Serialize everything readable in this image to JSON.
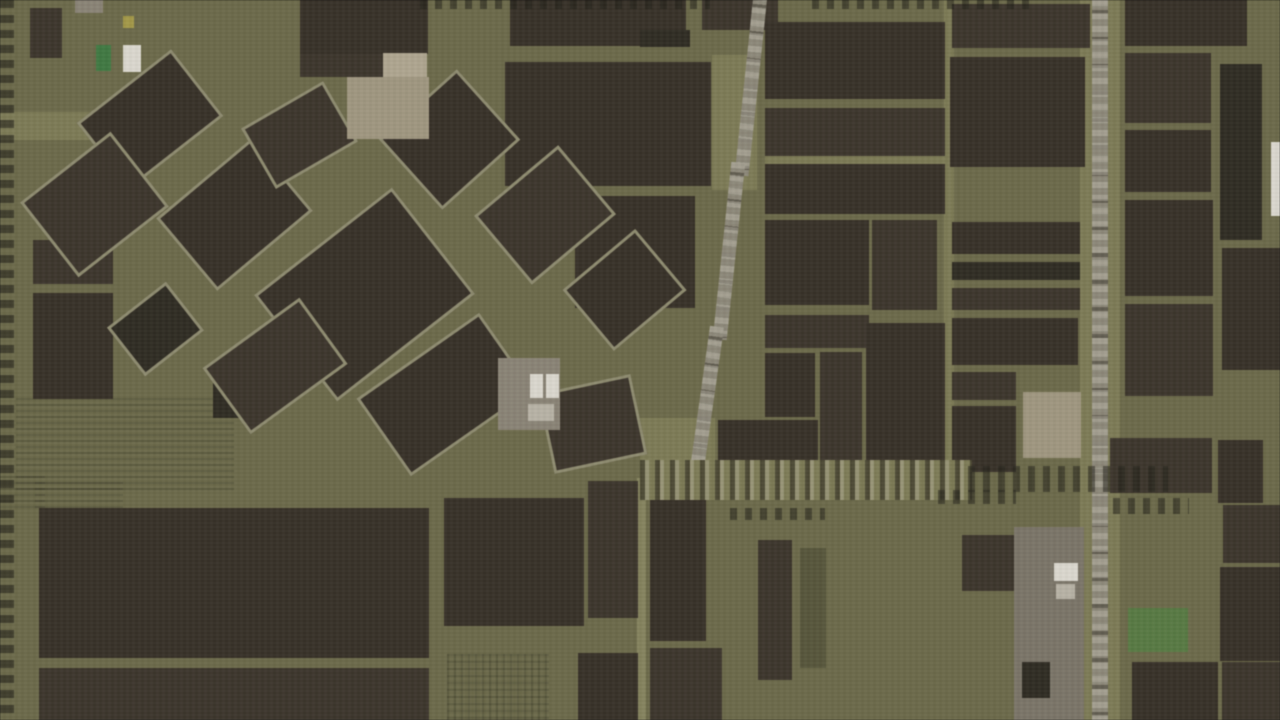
{
  "map": {
    "width": 1280,
    "height": 720,
    "palette": {
      "bg": "#6c6a47",
      "olight": "#7d7b53",
      "olight2": "#85835c",
      "odark": "#565538",
      "f1": "#362f26",
      "f2": "#3b342a",
      "f3": "#2e2a21",
      "tan": "#a1977f",
      "tanl": "#b0a78f",
      "gray": "#8b8475",
      "grayd": "#7b7567",
      "lgray": "#b9b4a6",
      "white": "#dddad0",
      "green": "#3d7a3f",
      "bgreen": "#567a40",
      "yellow": "#a59a43",
      "road": "#8d8878"
    },
    "shapes": [
      {
        "n": "light-band",
        "x": 0,
        "y": 112,
        "w": 100,
        "h": 28,
        "c": "olight"
      },
      {
        "n": "light-gap",
        "x": 944,
        "y": 0,
        "w": 10,
        "h": 476,
        "c": "olight"
      },
      {
        "n": "road-verge",
        "x": 1080,
        "y": 0,
        "w": 14,
        "h": 720,
        "c": "olight"
      },
      {
        "n": "road-verge",
        "x": 1108,
        "y": 0,
        "w": 12,
        "h": 720,
        "c": "olight"
      },
      {
        "n": "light-gap",
        "x": 765,
        "y": 152,
        "w": 182,
        "h": 12,
        "c": "olight"
      },
      {
        "n": "light-strip",
        "x": 637,
        "y": 478,
        "w": 9,
        "h": 242,
        "c": "olight2"
      },
      {
        "n": "light-patch",
        "x": 712,
        "y": 55,
        "w": 45,
        "h": 135,
        "c": "olight"
      },
      {
        "n": "light-patch",
        "x": 640,
        "y": 418,
        "w": 75,
        "h": 46,
        "c": "olight"
      },
      {
        "n": "orchard-rows",
        "x": 16,
        "y": 398,
        "w": 218,
        "h": 92,
        "t": "tx-rows"
      },
      {
        "n": "orchard-rows",
        "x": 0,
        "y": 476,
        "w": 45,
        "h": 32,
        "t": "tx-rows"
      },
      {
        "n": "orchard-rows",
        "x": 35,
        "y": 482,
        "w": 88,
        "h": 26,
        "t": "tx-rows"
      },
      {
        "n": "crop-grid",
        "x": 447,
        "y": 654,
        "w": 102,
        "h": 66,
        "t": "tx-grid"
      },
      {
        "n": "field-rows",
        "x": 730,
        "y": 508,
        "w": 95,
        "h": 12,
        "t": "tx-hdash"
      },
      {
        "n": "field-plot",
        "x": 30,
        "y": 8,
        "w": 32,
        "h": 50,
        "c": "f2"
      },
      {
        "n": "field-plot",
        "x": 300,
        "y": 0,
        "w": 128,
        "h": 54,
        "c": "f1"
      },
      {
        "n": "field-plot",
        "x": 300,
        "y": 54,
        "w": 84,
        "h": 23,
        "c": "f2"
      },
      {
        "n": "field-plot",
        "x": 510,
        "y": 0,
        "w": 176,
        "h": 46,
        "c": "f1"
      },
      {
        "n": "field-plot",
        "x": 702,
        "y": 0,
        "w": 76,
        "h": 30,
        "c": "f2"
      },
      {
        "n": "field-plot",
        "x": 505,
        "y": 62,
        "w": 206,
        "h": 124,
        "c": "f1"
      },
      {
        "n": "field-plot",
        "x": 640,
        "y": 30,
        "w": 50,
        "h": 17,
        "c": "f3"
      },
      {
        "n": "field-plot",
        "x": 765,
        "y": 22,
        "w": 180,
        "h": 77,
        "c": "f1"
      },
      {
        "n": "field-plot",
        "x": 765,
        "y": 108,
        "w": 180,
        "h": 48,
        "c": "f2"
      },
      {
        "n": "field-plot",
        "x": 765,
        "y": 164,
        "w": 180,
        "h": 50,
        "c": "f1"
      },
      {
        "n": "field-plot",
        "x": 952,
        "y": 4,
        "w": 138,
        "h": 44,
        "c": "f2"
      },
      {
        "n": "field-plot",
        "x": 950,
        "y": 57,
        "w": 135,
        "h": 110,
        "c": "f1"
      },
      {
        "n": "field-plot",
        "x": 1125,
        "y": 0,
        "w": 122,
        "h": 46,
        "c": "f1"
      },
      {
        "n": "field-plot",
        "x": 1125,
        "y": 53,
        "w": 86,
        "h": 70,
        "c": "f2"
      },
      {
        "n": "field-plot",
        "x": 1125,
        "y": 130,
        "w": 86,
        "h": 62,
        "c": "f1"
      },
      {
        "n": "field-plot",
        "x": 1220,
        "y": 64,
        "w": 42,
        "h": 176,
        "c": "f3"
      },
      {
        "n": "field-plot",
        "x": 1125,
        "y": 200,
        "w": 88,
        "h": 96,
        "c": "f1"
      },
      {
        "n": "field-plot",
        "x": 1125,
        "y": 304,
        "w": 88,
        "h": 92,
        "c": "f2"
      },
      {
        "n": "field-plot",
        "x": 1222,
        "y": 248,
        "w": 58,
        "h": 122,
        "c": "f1"
      },
      {
        "n": "field-plot",
        "x": 1110,
        "y": 438,
        "w": 102,
        "h": 55,
        "c": "f2"
      },
      {
        "n": "field-plot",
        "x": 1218,
        "y": 440,
        "w": 45,
        "h": 63,
        "c": "f1"
      },
      {
        "n": "field-plot",
        "x": 765,
        "y": 220,
        "w": 104,
        "h": 85,
        "c": "f1"
      },
      {
        "n": "field-plot",
        "x": 872,
        "y": 220,
        "w": 65,
        "h": 90,
        "c": "f2"
      },
      {
        "n": "field-plot",
        "x": 765,
        "y": 315,
        "w": 104,
        "h": 33,
        "c": "f2"
      },
      {
        "n": "field-plot",
        "x": 765,
        "y": 353,
        "w": 50,
        "h": 64,
        "c": "f1"
      },
      {
        "n": "field-plot",
        "x": 820,
        "y": 352,
        "w": 42,
        "h": 120,
        "c": "f2"
      },
      {
        "n": "field-plot",
        "x": 866,
        "y": 323,
        "w": 79,
        "h": 150,
        "c": "f1"
      },
      {
        "n": "field-plot",
        "x": 952,
        "y": 222,
        "w": 128,
        "h": 32,
        "c": "f1"
      },
      {
        "n": "field-plot",
        "x": 952,
        "y": 262,
        "w": 128,
        "h": 18,
        "c": "f3"
      },
      {
        "n": "field-plot",
        "x": 952,
        "y": 288,
        "w": 128,
        "h": 22,
        "c": "f2"
      },
      {
        "n": "field-plot",
        "x": 952,
        "y": 318,
        "w": 126,
        "h": 47,
        "c": "f1"
      },
      {
        "n": "field-plot",
        "x": 952,
        "y": 372,
        "w": 64,
        "h": 28,
        "c": "f2"
      },
      {
        "n": "field-plot",
        "x": 952,
        "y": 406,
        "w": 64,
        "h": 66,
        "c": "f1"
      },
      {
        "n": "field-plot",
        "x": 575,
        "y": 196,
        "w": 120,
        "h": 112,
        "c": "f1"
      },
      {
        "n": "field-plot",
        "x": 718,
        "y": 420,
        "w": 100,
        "h": 46,
        "c": "f1"
      },
      {
        "n": "field-plot",
        "x": 33,
        "y": 240,
        "w": 80,
        "h": 44,
        "c": "f2"
      },
      {
        "n": "field-plot",
        "x": 33,
        "y": 293,
        "w": 80,
        "h": 106,
        "c": "f1"
      },
      {
        "n": "field-plot",
        "x": 39,
        "y": 508,
        "w": 390,
        "h": 150,
        "c": "f1"
      },
      {
        "n": "field-plot",
        "x": 39,
        "y": 668,
        "w": 390,
        "h": 52,
        "c": "f2"
      },
      {
        "n": "field-plot",
        "x": 213,
        "y": 380,
        "w": 30,
        "h": 38,
        "c": "f3"
      },
      {
        "n": "field-plot",
        "x": 444,
        "y": 498,
        "w": 140,
        "h": 128,
        "c": "f1"
      },
      {
        "n": "field-plot",
        "x": 588,
        "y": 481,
        "w": 50,
        "h": 137,
        "c": "f2"
      },
      {
        "n": "field-plot",
        "x": 650,
        "y": 488,
        "w": 56,
        "h": 153,
        "c": "f1"
      },
      {
        "n": "field-plot",
        "x": 578,
        "y": 653,
        "w": 60,
        "h": 67,
        "c": "f1"
      },
      {
        "n": "field-plot",
        "x": 650,
        "y": 648,
        "w": 72,
        "h": 72,
        "c": "f2"
      },
      {
        "n": "field-plot",
        "x": 962,
        "y": 535,
        "w": 82,
        "h": 56,
        "c": "f2"
      },
      {
        "n": "field-plot",
        "x": 1132,
        "y": 662,
        "w": 86,
        "h": 58,
        "c": "f1"
      },
      {
        "n": "field-plot",
        "x": 1220,
        "y": 567,
        "w": 60,
        "h": 94,
        "c": "f1"
      },
      {
        "n": "field-plot",
        "x": 1223,
        "y": 505,
        "w": 57,
        "h": 58,
        "c": "f2"
      },
      {
        "n": "field-plot",
        "x": 1222,
        "y": 662,
        "w": 58,
        "h": 58,
        "c": "f2"
      },
      {
        "n": "field-strip",
        "x": 758,
        "y": 540,
        "w": 34,
        "h": 140,
        "c": "f2"
      },
      {
        "n": "field-strip",
        "x": 800,
        "y": 548,
        "w": 26,
        "h": 120,
        "c": "odark"
      },
      {
        "n": "field-plot-rotated",
        "x": 90,
        "y": 77,
        "w": 120,
        "h": 85,
        "c": "f1",
        "r": -38
      },
      {
        "n": "field-plot-rotated",
        "x": 37,
        "y": 157,
        "w": 115,
        "h": 95,
        "c": "f2",
        "r": -38
      },
      {
        "n": "field-plot-rotated",
        "x": 172,
        "y": 167,
        "w": 125,
        "h": 95,
        "c": "f1",
        "r": -40
      },
      {
        "n": "field-plot-rotated",
        "x": 277,
        "y": 227,
        "w": 175,
        "h": 135,
        "c": "f1",
        "r": -38
      },
      {
        "n": "field-plot-rotated",
        "x": 252,
        "y": 100,
        "w": 95,
        "h": 70,
        "c": "f2",
        "r": -30
      },
      {
        "n": "field-plot-rotated",
        "x": 397,
        "y": 92,
        "w": 105,
        "h": 95,
        "c": "f1",
        "r": -42
      },
      {
        "n": "field-plot-rotated",
        "x": 490,
        "y": 170,
        "w": 110,
        "h": 90,
        "c": "f2",
        "r": -40
      },
      {
        "n": "field-plot-rotated",
        "x": 577,
        "y": 250,
        "w": 95,
        "h": 80,
        "c": "f1",
        "r": -40
      },
      {
        "n": "field-plot-rotated",
        "x": 370,
        "y": 347,
        "w": 150,
        "h": 95,
        "c": "f1",
        "r": -35
      },
      {
        "n": "field-plot-rotated",
        "x": 545,
        "y": 383,
        "w": 95,
        "h": 82,
        "c": "f2",
        "r": -12
      },
      {
        "n": "field-plot-rotated",
        "x": 118,
        "y": 298,
        "w": 75,
        "h": 62,
        "c": "f3",
        "r": -38
      },
      {
        "n": "field-plot-rotated",
        "x": 215,
        "y": 325,
        "w": 120,
        "h": 82,
        "c": "f2",
        "r": -36
      },
      {
        "n": "bare-field",
        "x": 347,
        "y": 77,
        "w": 82,
        "h": 62,
        "c": "tan"
      },
      {
        "n": "bare-field",
        "x": 383,
        "y": 53,
        "w": 44,
        "h": 24,
        "c": "tanl"
      },
      {
        "n": "bare-field",
        "x": 1023,
        "y": 392,
        "w": 58,
        "h": 66,
        "c": "tan"
      },
      {
        "n": "farmstead-ground",
        "x": 498,
        "y": 358,
        "w": 62,
        "h": 72,
        "c": "gray"
      },
      {
        "n": "farmstead-ground",
        "x": 1014,
        "y": 527,
        "w": 70,
        "h": 193,
        "c": "grayd"
      },
      {
        "n": "bare-patch",
        "x": 75,
        "y": 0,
        "w": 28,
        "h": 13,
        "c": "gray"
      },
      {
        "n": "field-plot",
        "x": 1022,
        "y": 662,
        "w": 28,
        "h": 36,
        "c": "f3"
      },
      {
        "n": "meadow-patch",
        "x": 1128,
        "y": 608,
        "w": 60,
        "h": 44,
        "c": "bgreen"
      },
      {
        "n": "tree-line",
        "x": 0,
        "y": 0,
        "w": 14,
        "h": 720,
        "t": "tx-vdash"
      },
      {
        "n": "road",
        "x": 1092,
        "y": 0,
        "w": 16,
        "h": 720,
        "c": "road",
        "t": "tx-road-v"
      },
      {
        "n": "road",
        "x": 744,
        "y": -6,
        "w": 14,
        "h": 182,
        "c": "road",
        "t": "tx-road-v",
        "r": 6
      },
      {
        "n": "road",
        "x": 722,
        "y": 162,
        "w": 14,
        "h": 178,
        "c": "road",
        "t": "tx-road-v",
        "r": 6
      },
      {
        "n": "road",
        "x": 699,
        "y": 326,
        "w": 14,
        "h": 158,
        "c": "road",
        "t": "tx-road-v",
        "r": 8
      },
      {
        "n": "tree-lined-road",
        "x": 640,
        "y": 460,
        "w": 332,
        "h": 40,
        "c": "olight",
        "t": "tx-treeroad"
      },
      {
        "n": "tree-line",
        "x": 968,
        "y": 466,
        "w": 200,
        "h": 26,
        "t": "tx-hdash"
      },
      {
        "n": "tree-line",
        "x": 420,
        "y": 0,
        "w": 290,
        "h": 9,
        "t": "tx-hdash"
      },
      {
        "n": "tree-line",
        "x": 812,
        "y": 0,
        "w": 224,
        "h": 9,
        "t": "tx-hdash"
      },
      {
        "n": "hedge-row",
        "x": 1113,
        "y": 498,
        "w": 76,
        "h": 16,
        "t": "tx-hdash"
      },
      {
        "n": "hedge-row",
        "x": 938,
        "y": 490,
        "w": 78,
        "h": 14,
        "t": "tx-hdash"
      },
      {
        "n": "farm-building",
        "x": 530,
        "y": 374,
        "w": 13,
        "h": 24,
        "c": "white"
      },
      {
        "n": "farm-building",
        "x": 546,
        "y": 374,
        "w": 13,
        "h": 24,
        "c": "white"
      },
      {
        "n": "farm-building",
        "x": 528,
        "y": 404,
        "w": 26,
        "h": 17,
        "c": "lgray"
      },
      {
        "n": "farm-building",
        "x": 1054,
        "y": 563,
        "w": 24,
        "h": 18,
        "c": "white"
      },
      {
        "n": "farm-building",
        "x": 1056,
        "y": 584,
        "w": 19,
        "h": 15,
        "c": "lgray"
      },
      {
        "n": "edge-marker",
        "x": 1271,
        "y": 142,
        "w": 9,
        "h": 74,
        "c": "white"
      },
      {
        "n": "map-marker-green",
        "x": 96,
        "y": 45,
        "w": 15,
        "h": 26,
        "c": "green"
      },
      {
        "n": "map-marker-light",
        "x": 123,
        "y": 45,
        "w": 18,
        "h": 27,
        "c": "white"
      },
      {
        "n": "map-marker-yellow",
        "x": 123,
        "y": 16,
        "w": 11,
        "h": 12,
        "c": "yellow"
      }
    ]
  }
}
